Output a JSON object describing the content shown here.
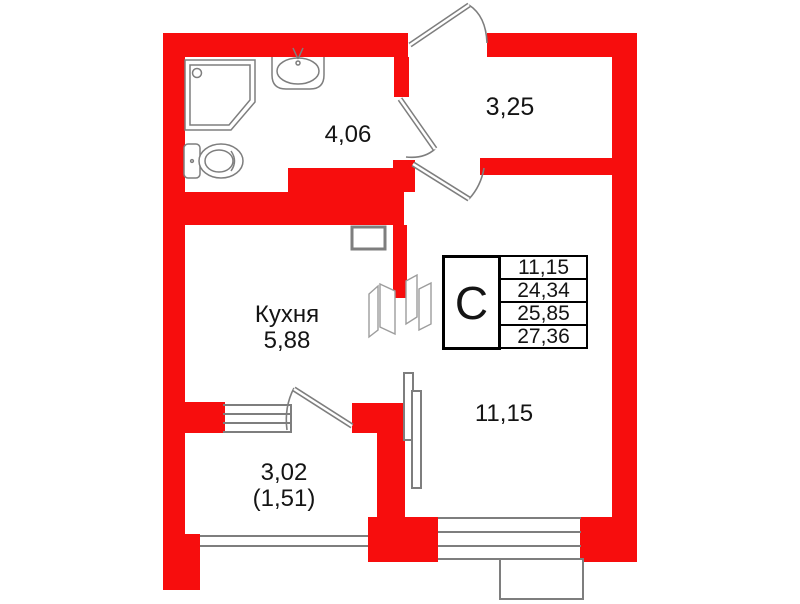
{
  "plan": {
    "colors": {
      "wall": "#f70d0d",
      "line": "#7e7e7e",
      "text": "#141414"
    },
    "rooms": {
      "bathroom": {
        "area": "4,06"
      },
      "hallway": {
        "area": "3,25"
      },
      "kitchen": {
        "name": "Кухня",
        "area": "5,88"
      },
      "living": {
        "area": "11,15"
      },
      "balcony": {
        "area": "3,02",
        "area_note": "(1,51)"
      }
    },
    "info_table": {
      "unit_type": "С",
      "values": [
        "11,15",
        "24,34",
        "25,85",
        "27,36"
      ]
    }
  }
}
